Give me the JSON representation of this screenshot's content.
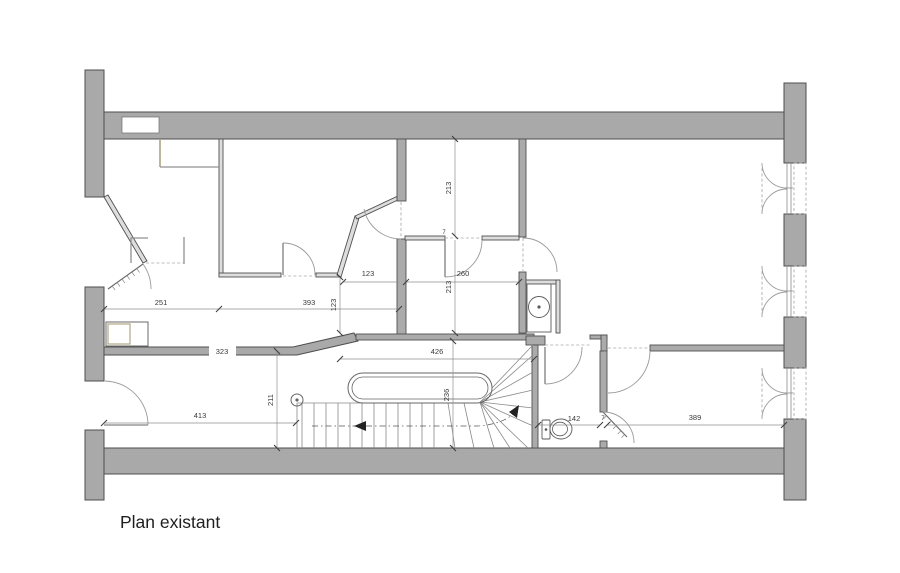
{
  "drawing": {
    "title": "Plan existant",
    "dims": {
      "d251": "251",
      "d393": "393",
      "d123_h": "123",
      "d123_v": "123",
      "d260": "260",
      "d213_upper": "213",
      "d213_lower": "213",
      "d7_upper": "7",
      "d323": "323",
      "d426": "426",
      "d236": "236",
      "d211": "211",
      "d413": "413",
      "d142": "142",
      "d389": "389",
      "d7_lower": "7"
    },
    "fixtures": {
      "washbasin": "washbasin",
      "toilet": "toilet",
      "staircase": "staircase-with-winders",
      "windows": "casement-windows"
    },
    "colors": {
      "wall_fill": "#a9a9a9",
      "wall_stroke": "#4e4e4e",
      "partition_fill": "#dddddd",
      "dim_text": "#3a3a3a",
      "dim_line": "#8f8f8f",
      "wood_accent": "#b7ae8e",
      "background": "#ffffff",
      "title_color": "#1f1f1f"
    }
  }
}
